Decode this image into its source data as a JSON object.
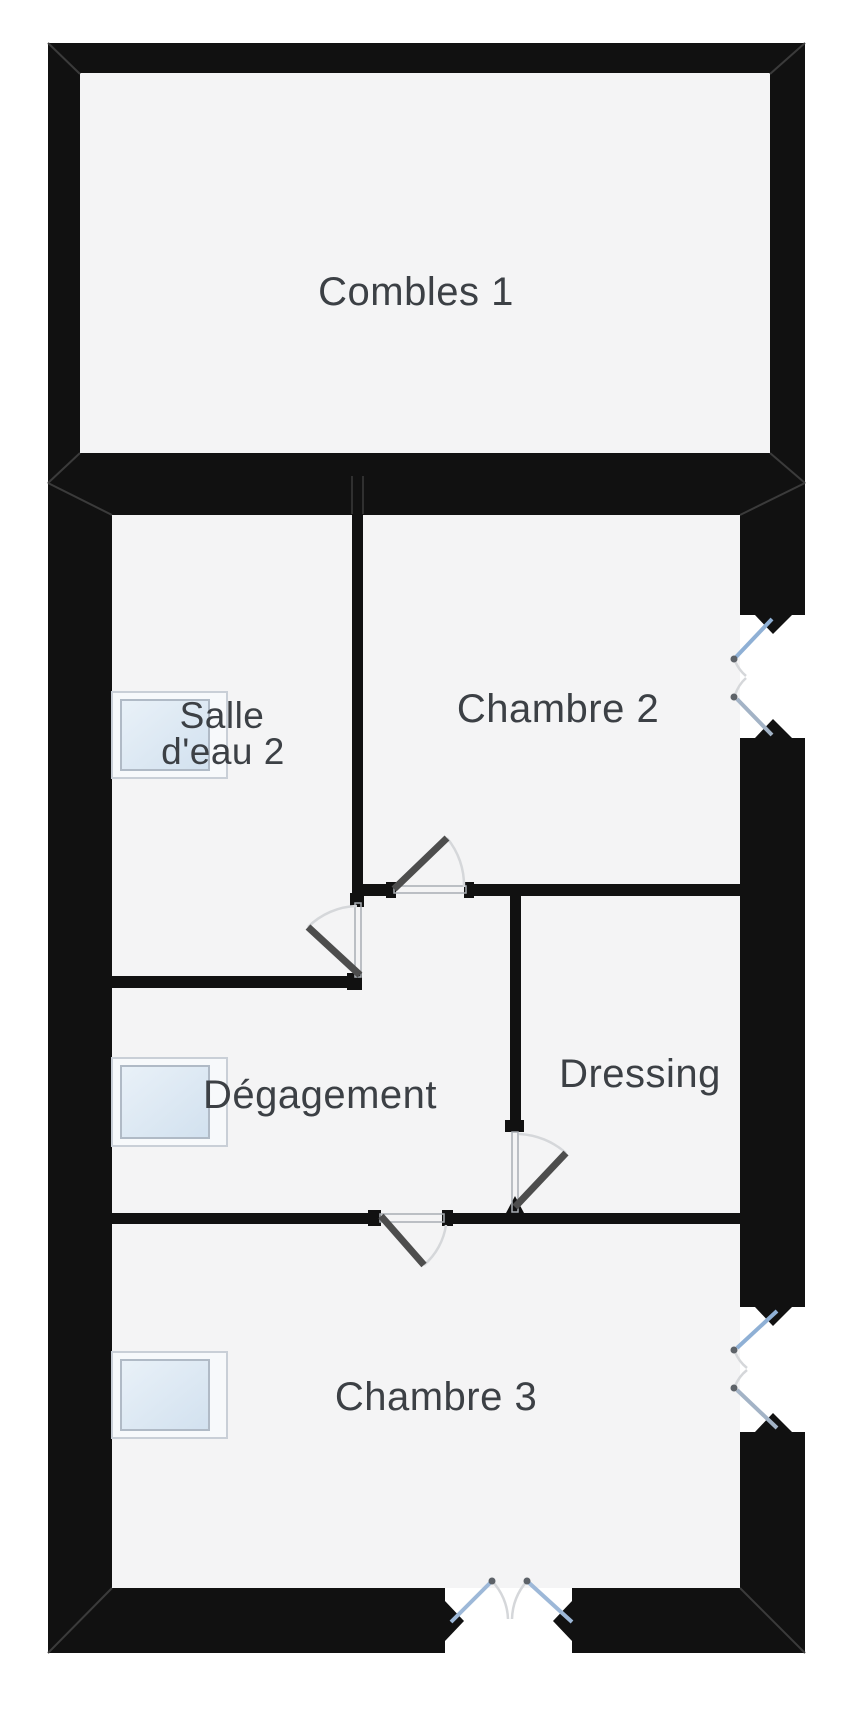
{
  "document": {
    "kind": "floor-plan"
  },
  "colors": {
    "page_bg": "#ffffff",
    "wall": "#111111",
    "floor": "#f4f4f5",
    "label_text": "#3c4045",
    "window_frame": "#c9cfd7",
    "window_glass_light": "#e9f1f8",
    "window_glass_dark": "#d2e1ef",
    "casement_blue": "#8fb0d5",
    "casement_gray": "#a3b3c6",
    "entry_leaf_blue": "#9db8d8",
    "door_leaf": "#4d4d4d",
    "swing_arc": "#d5d7da",
    "threshold": "#a8adb3",
    "seam": "#3b3b3b",
    "hinge_dot": "#5d6268"
  },
  "rooms": [
    {
      "id": "combles-1",
      "label": "Combles 1"
    },
    {
      "id": "salle-deau-2",
      "label_lines": [
        "Salle",
        "d'eau 2"
      ]
    },
    {
      "id": "chambre-2",
      "label": "Chambre 2"
    },
    {
      "id": "degagement",
      "label": "Dégagement"
    },
    {
      "id": "dressing",
      "label": "Dressing"
    },
    {
      "id": "chambre-3",
      "label": "Chambre 3"
    }
  ],
  "fixtures": {
    "roof_windows": 3,
    "casement_windows": 2,
    "interior_doors": 4,
    "entry_double_doors": 1
  }
}
